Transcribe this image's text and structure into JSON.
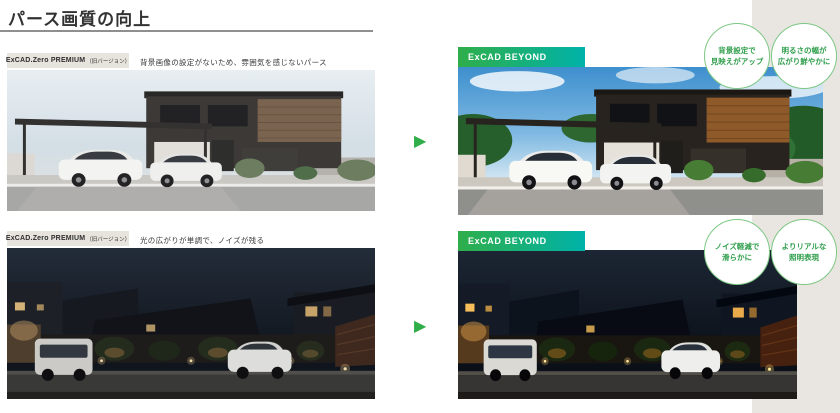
{
  "title": "パース画質の向上",
  "colors": {
    "accent_green": "#2fae4a",
    "accent_teal": "#00b2a9",
    "badge_border": "#7cc884",
    "badge_text": "#2f9e4c",
    "panel_beige": "#e9e6e1",
    "label_bg": "#e7e4de",
    "text_dark": "#333333"
  },
  "icons": {
    "arrow_right": "▶"
  },
  "rows": [
    {
      "id": "daytime",
      "old_product": "ExCAD.Zero PREMIUM",
      "old_version": "（旧バージョン）",
      "old_caption": "背景画像の設定がないため、雰囲気を感じないパース",
      "new_label": "ExCAD BEYOND",
      "badges": [
        {
          "line1": "背景設定で",
          "line2": "見映えがアップ"
        },
        {
          "line1": "明るさの幅が",
          "line2": "広がり鮮やかに"
        }
      ]
    },
    {
      "id": "night",
      "old_product": "ExCAD.Zero PREMIUM",
      "old_version": "（旧バージョン）",
      "old_caption": "光の広がりが単調で、ノイズが残る",
      "new_label": "ExCAD BEYOND",
      "badges": [
        {
          "line1": "ノイズ軽減で",
          "line2": "滑らかに"
        },
        {
          "line1": "よりリアルな",
          "line2": "照明表現"
        }
      ]
    }
  ]
}
